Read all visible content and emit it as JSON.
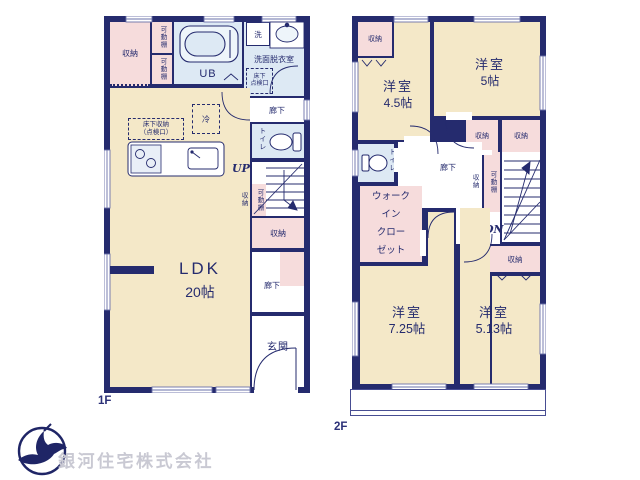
{
  "colors": {
    "wall": "#252b6e",
    "room_floor": "#f4e8c8",
    "closet": "#f6dcdc",
    "wet_area": "#dde9f4",
    "logo_blue": "#1f2566",
    "logo_text_gray": "#c9c9d3"
  },
  "f1": {
    "floor_label": "1F",
    "ldk": {
      "name": "LDK",
      "size": "20帖"
    },
    "closet_nw": "収納",
    "shelf_top": "可動棚",
    "shelf_bottom": "可動棚",
    "ub": "UB",
    "washer": "洗",
    "washroom": "洗面脱衣室",
    "floor_hatch": [
      "床下",
      "点検口"
    ],
    "hall_upper": "廊下",
    "toilet": "トイレ",
    "up": "UP",
    "fridge": "冷",
    "underfloor_storage": [
      "床下収納",
      "（点検口）"
    ],
    "stair_side_storage": "収納",
    "stair_shelf": "可動棚",
    "mid_storage": "収納",
    "hall_lower": "廊下",
    "entrance": "玄関"
  },
  "f2": {
    "floor_label": "2F",
    "closet_nw": "収納",
    "room_45": {
      "name": "洋室",
      "size": "4.5帖"
    },
    "room_5": {
      "name": "洋室",
      "size": "5帖"
    },
    "closet_a": "収納",
    "closet_b": "収納",
    "toilet": "トイレ",
    "hall": "廊下",
    "stair_side_storage": "収納",
    "stair_shelf": "可動棚",
    "dn": "DN",
    "wic_lines": [
      "ウォーク",
      "イン",
      "クロー",
      "ゼット"
    ],
    "under_stair_storage": "収納",
    "room_725": {
      "name": "洋室",
      "size": "7.25帖"
    },
    "room_513": {
      "name": "洋室",
      "size": "5.13帖"
    }
  },
  "footer": {
    "company": "銀河住宅株式会社"
  }
}
